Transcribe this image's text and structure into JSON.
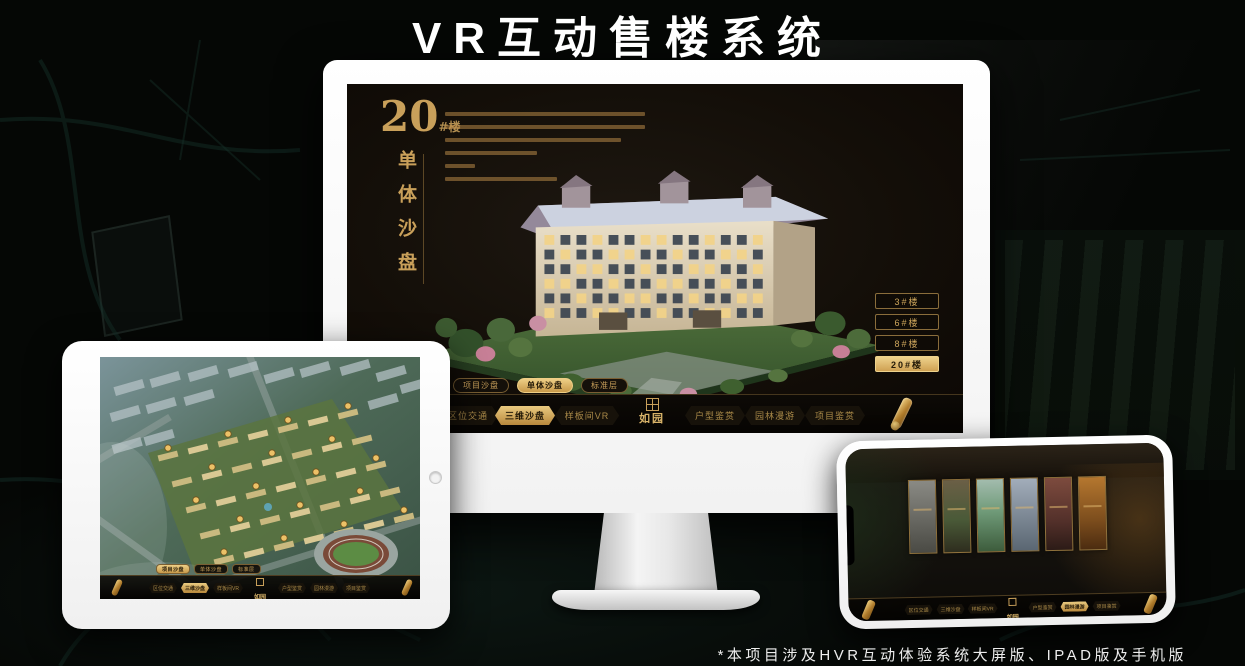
{
  "page": {
    "title": "VR互动售楼系统",
    "footnote": "*本项目涉及HVR互动体验系统大屏版、IPAD版及手机版"
  },
  "brand": {
    "name": "如园"
  },
  "colors": {
    "accent_gold": "#c9a05a",
    "active_gold": "#e3b968",
    "nav_background": "#0d0a06",
    "screen_background": "#16110b",
    "monitor_body": "#ffffff"
  },
  "tabs": [
    {
      "label": "项目沙盘"
    },
    {
      "label": "单体沙盘"
    },
    {
      "label": "标准层"
    }
  ],
  "nav": [
    {
      "label": "区位交通"
    },
    {
      "label": "三维沙盘"
    },
    {
      "label": "样板间VR"
    },
    {
      "label": "户型鉴赏"
    },
    {
      "label": "园林漫游"
    },
    {
      "label": "项目鉴赏"
    }
  ],
  "desktop": {
    "building_number": "20",
    "building_unit": "#楼",
    "panel_title": "单体沙盘",
    "active_tab": "单体沙盘",
    "active_nav": "三维沙盘",
    "floor_buttons": [
      {
        "label": "3#楼"
      },
      {
        "label": "6#楼"
      },
      {
        "label": "8#楼"
      },
      {
        "label": "20#楼"
      }
    ],
    "active_floor": "20#楼"
  },
  "tablet": {
    "active_tab": "项目沙盘",
    "active_nav": "三维沙盘"
  },
  "phone": {
    "active_nav": "园林漫游"
  },
  "icons": {
    "scroll": "gold-scroll-ribbon",
    "seal": "square-seal",
    "home_button": "circle"
  }
}
